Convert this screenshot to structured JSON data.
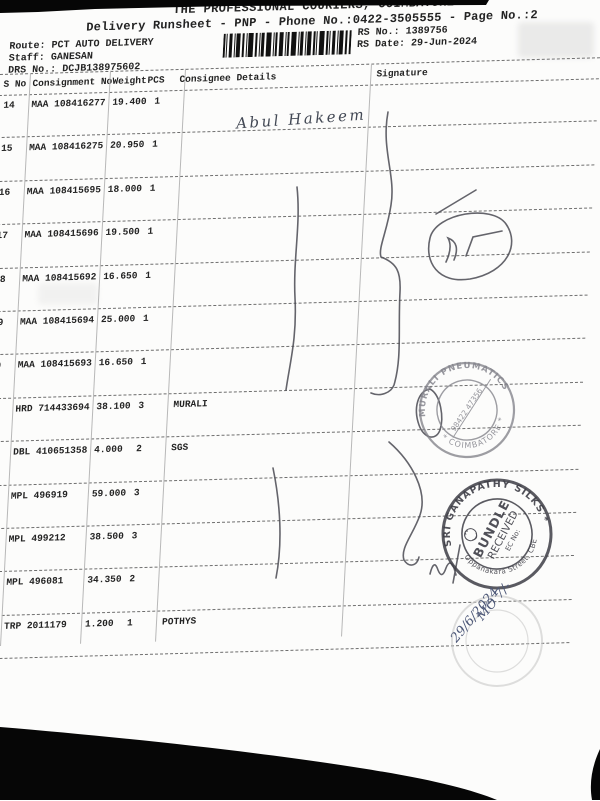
{
  "document": {
    "title": "THE PROFESSIONAL COURIERS, COIMBATORE",
    "subtitle": "Delivery Runsheet - PNP - Phone No.:0422-3505555 - Page No.:2"
  },
  "info": {
    "route_label": "Route:",
    "route_value": "PCT AUTO DELIVERY",
    "staff_label": "Staff:",
    "staff_value": "GANESAN",
    "drs_label": "DRS No.:",
    "drs_value": "DCJB138975602",
    "rs_no_label": "RS No.:",
    "rs_no_value": "1389756",
    "rs_date_label": "RS Date:",
    "rs_date_value": "29-Jun-2024"
  },
  "table": {
    "headers": {
      "sno": "S No",
      "consignment": "Consignment No",
      "weight": "Weight",
      "pcs": "PCS",
      "consignee": "Consignee Details",
      "signature": "Signature"
    },
    "rows": [
      {
        "sno": "14",
        "consignment": "MAA 108416277",
        "weight": "19.400",
        "pcs": "1",
        "consignee": ""
      },
      {
        "sno": "15",
        "consignment": "MAA 108416275",
        "weight": "20.950",
        "pcs": "1",
        "consignee": ""
      },
      {
        "sno": "16",
        "consignment": "MAA 108415695",
        "weight": "18.000",
        "pcs": "1",
        "consignee": ""
      },
      {
        "sno": "17",
        "consignment": "MAA 108415696",
        "weight": "19.500",
        "pcs": "1",
        "consignee": ""
      },
      {
        "sno": "18",
        "consignment": "MAA 108415692",
        "weight": "16.650",
        "pcs": "1",
        "consignee": ""
      },
      {
        "sno": "19",
        "consignment": "MAA 108415694",
        "weight": "25.000",
        "pcs": "1",
        "consignee": ""
      },
      {
        "sno": "20",
        "consignment": "MAA 108415693",
        "weight": "16.650",
        "pcs": "1",
        "consignee": ""
      },
      {
        "sno": "21",
        "consignment": "HRD 714433694",
        "weight": "38.100",
        "pcs": "3",
        "consignee": "MURALI"
      },
      {
        "sno": "22",
        "consignment": "DBL 410651358",
        "weight": "4.000",
        "pcs": "2",
        "consignee": "SGS"
      },
      {
        "sno": "23",
        "consignment": "MPL 496919",
        "weight": "59.000",
        "pcs": "3",
        "consignee": ""
      },
      {
        "sno": "24",
        "consignment": "MPL 499212",
        "weight": "38.500",
        "pcs": "3",
        "consignee": ""
      },
      {
        "sno": "25",
        "consignment": "MPL 496081",
        "weight": "34.350",
        "pcs": "2",
        "consignee": ""
      },
      {
        "sno": "26",
        "consignment": "TRP 2011179",
        "weight": "1.200",
        "pcs": "1",
        "consignee": "POTHYS"
      }
    ]
  },
  "handwriting": {
    "consignee_signature_name": "Abul Hakeem",
    "date_note_line1": "MO 7/-",
    "date_note_line2": "29/6/2024",
    "ink_color": "#4d5878"
  },
  "stamps": {
    "murali": {
      "arc_top": "MURALI PNEUMATICS",
      "arc_bottom": "* COIMBATORE *",
      "center_text": "98422 47356",
      "color": "#85858d"
    },
    "ganapathy": {
      "arc_top": "SRI GANAPATHY SILKS *",
      "arc_bottom": "Oppanakara Street, CBE",
      "inner_line1": "BUNDLE",
      "inner_line2": "RECEIVED",
      "inner_line3": "EC No:",
      "color": "#3e3e46"
    }
  }
}
